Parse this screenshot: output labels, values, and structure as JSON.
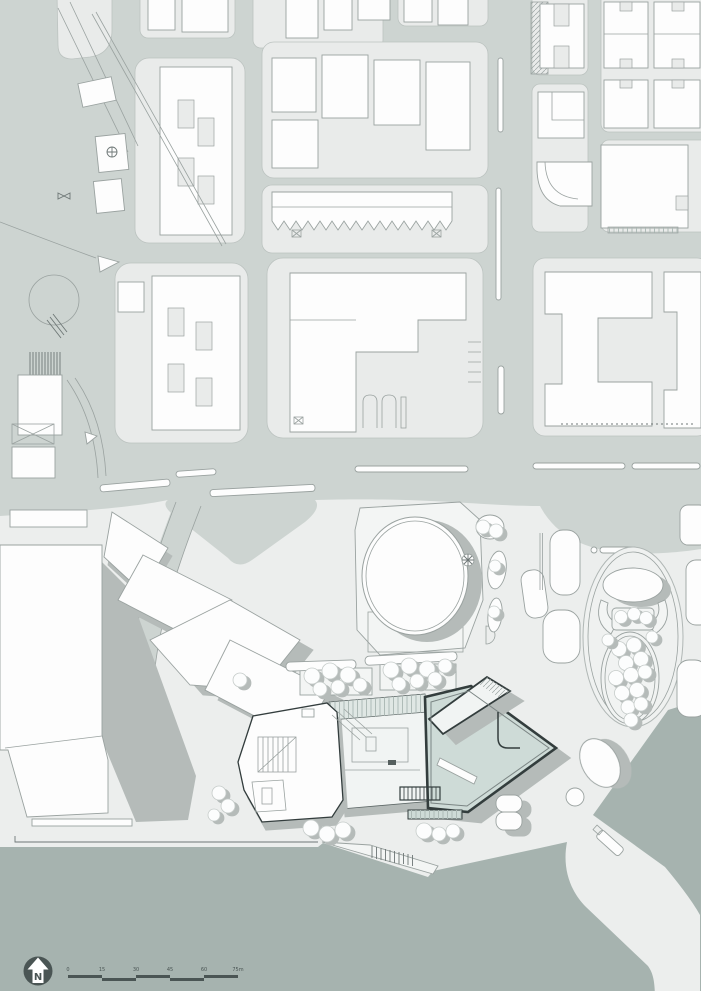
{
  "document": {
    "type": "architectural-site-plan",
    "description": "Urban site plan with street grid, highlighted waterfront building, plaza, oval garden and harbour water"
  },
  "colors": {
    "street": "#cdd4d1",
    "block": "#e9ebea",
    "panelEdge": "#bcc3c0",
    "building": "#fdfdfd",
    "buildingOutline": "#9aa2a0",
    "lineDark": "#6e7776",
    "water": "#a6b3af",
    "shadow": "#b5bbb9",
    "shadowDark": "#adb2b0",
    "plaza": "#eceeed",
    "pad": "#f3f5f4",
    "highlightFill": "#cedbd7",
    "highlightRoof": "#dfe7e4",
    "highlightWall": "#333d3d",
    "wingFill": "#f1f4f3",
    "ink": "#4a5554",
    "treeOutline": "#c6ccca"
  },
  "north_indicator": {
    "label": "N"
  },
  "scale_bar": {
    "tick_labels": [
      "0",
      "15",
      "30",
      "45",
      "60",
      "75m"
    ],
    "unit": "m"
  },
  "features": [
    "city-blocks",
    "street-grid",
    "avenue-medians",
    "plaza",
    "circular-theatre",
    "oval-garden",
    "main-building-highlighted",
    "waterfront-promenade",
    "pier",
    "jetty-steps",
    "trees",
    "water"
  ]
}
